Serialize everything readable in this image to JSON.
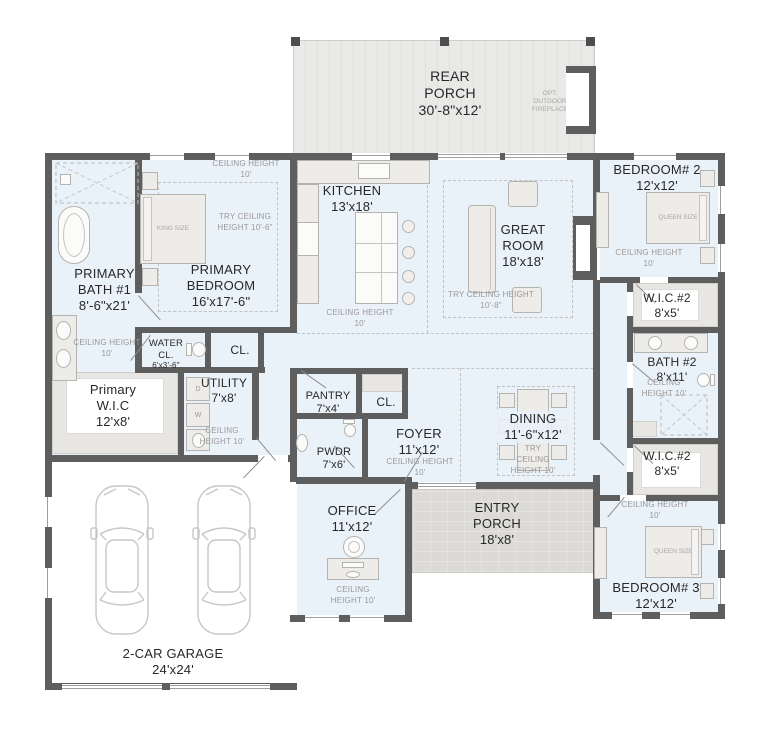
{
  "colors": {
    "room_fill": "#e9f1f9",
    "wall": "#5e5e5e",
    "porch_fill": "#e9e9e8",
    "stone_fill": "#dbdad7",
    "garage_fill": "#ffffff",
    "label_dark": "#282828",
    "label_gray": "#9b9998",
    "furniture_fill": "#edece9",
    "furniture_stroke": "#b5b3b0"
  },
  "rooms": {
    "rear_porch": {
      "name": "REAR PORCH",
      "dims": "30'-8\"x12'",
      "fireplace_note": "OPT. OUTDOOR FIREPLACE"
    },
    "kitchen": {
      "name": "KITCHEN",
      "dims": "13'x18'",
      "ceiling": "CEILING HEIGHT 10'"
    },
    "great_room": {
      "name": "GREAT ROOM",
      "dims": "18'x18'",
      "try_ceiling": "TRY CEILING HEIGHT 10'-8\""
    },
    "primary_bath": {
      "name": "PRIMARY BATH #1",
      "dims": "8'-6\"x21'",
      "ceiling": "CEILING HEIGHT 10'"
    },
    "primary_bedroom": {
      "name": "PRIMARY BEDROOM",
      "dims": "16'x17'-6\"",
      "ceiling": "CEILING HEIGHT 10'",
      "try_ceiling": "TRY CEILING HEIGHT 10'-6\"",
      "bed": "KING SIZE"
    },
    "water_closet": {
      "name": "WATER CL.",
      "dims": "6'x3'-6\""
    },
    "hall_closet": {
      "name": "CL."
    },
    "primary_wic": {
      "name": "Primary W.I.C",
      "dims": "12'x8'"
    },
    "utility": {
      "name": "UTILITY",
      "dims": "7'x8'",
      "ceiling": "CEILING HEIGHT 10'",
      "dryer": "D",
      "washer": "W"
    },
    "pantry": {
      "name": "PANTRY",
      "dims": "7'x4'"
    },
    "foyer_closet": {
      "name": "CL."
    },
    "powder": {
      "name": "PWDR",
      "dims": "7'x6'"
    },
    "foyer": {
      "name": "FOYER",
      "dims": "11'x12'",
      "ceiling": "CEILING HEIGHT 10'"
    },
    "dining": {
      "name": "DINING",
      "dims": "11'-6\"x12'",
      "try_ceiling": "TRY CEILING HEIGHT 10'"
    },
    "office": {
      "name": "OFFICE",
      "dims": "11'x12'",
      "ceiling": "CEILING HEIGHT 10'"
    },
    "entry_porch": {
      "name": "ENTRY PORCH",
      "dims": "18'x8'"
    },
    "bedroom_2": {
      "name": "BEDROOM# 2",
      "dims": "12'x12'",
      "ceiling": "CEILING HEIGHT 10'",
      "bed": "QUEEN SIZE"
    },
    "wic_2_upper": {
      "name": "W.I.C.#2",
      "dims": "8'x5'"
    },
    "bath_2": {
      "name": "BATH #2",
      "dims": "8'x11'",
      "ceiling": "CEILING HEIGHT 10'"
    },
    "wic_2_lower": {
      "name": "W.I.C.#2",
      "dims": "8'x5'"
    },
    "bedroom_3": {
      "name": "BEDROOM# 3",
      "dims": "12'x12'",
      "ceiling": "CEILING HEIGHT 10'",
      "bed": "QUEEN SIZE"
    },
    "garage": {
      "name": "2-CAR GARAGE",
      "dims": "24'x24'"
    }
  }
}
